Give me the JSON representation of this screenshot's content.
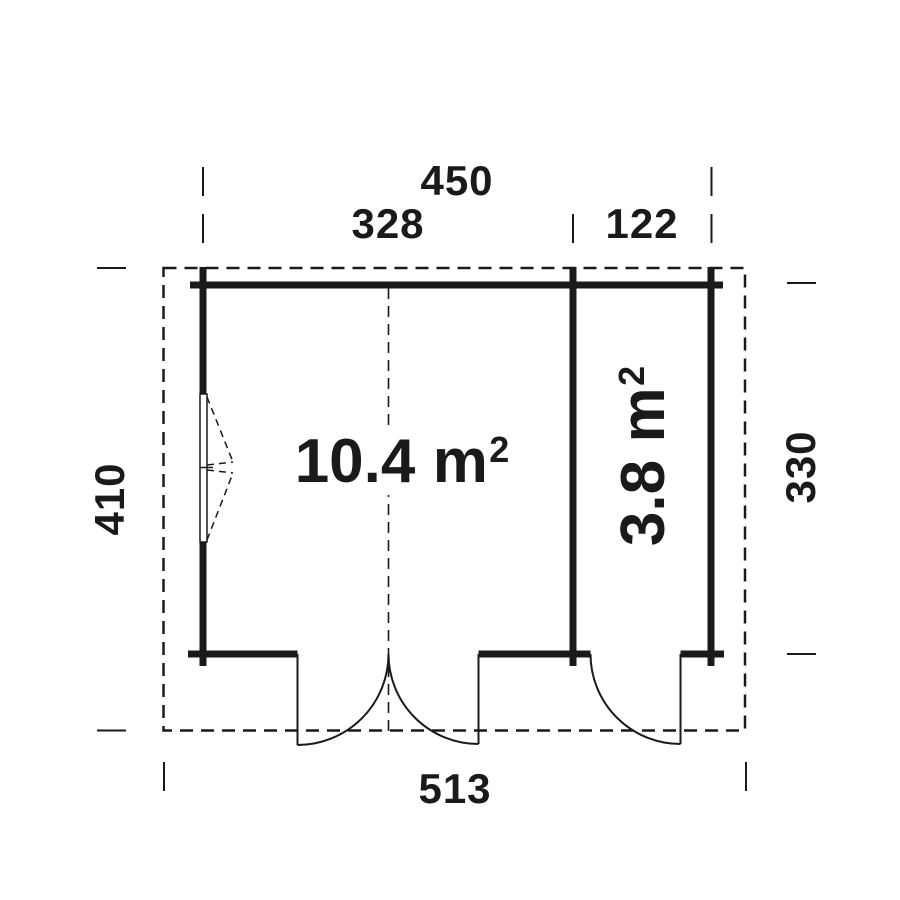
{
  "colors": {
    "background": "#ffffff",
    "line": "#1a1a1a"
  },
  "dimension_labels": {
    "top_total": "450",
    "top_main": "328",
    "top_annex": "122",
    "left_height": "410",
    "right_height": "330",
    "bottom_total": "513"
  },
  "room_labels": {
    "main": {
      "value": "10.4",
      "unit": "m",
      "exponent": "2"
    },
    "annex": {
      "value": "3.8",
      "unit": "m",
      "exponent": "2"
    }
  }
}
